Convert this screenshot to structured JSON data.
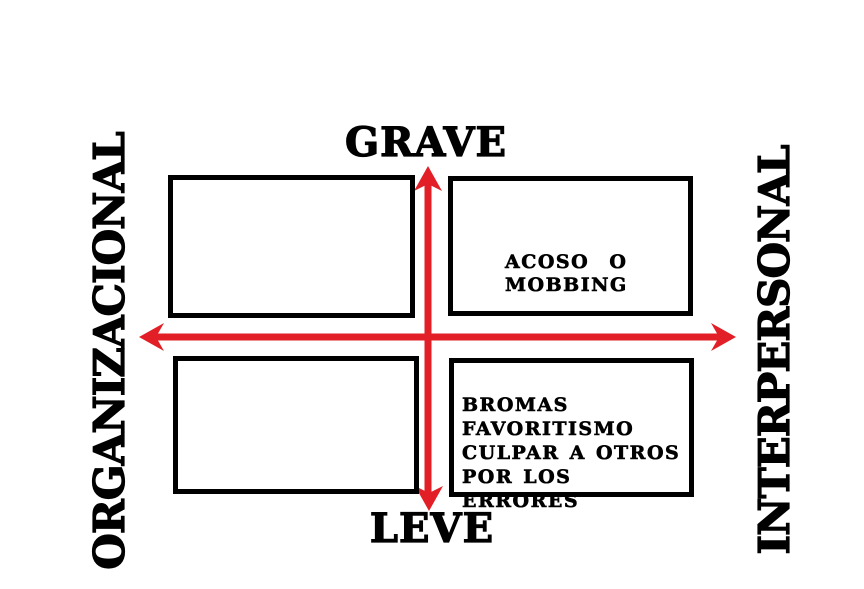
{
  "diagram": {
    "type": "quadrant-matrix",
    "subject": "workplace-conflict-severity-matrix",
    "colors": {
      "arrow_red": "#e21f26",
      "ink_black": "#000000",
      "background": "#ffffff"
    },
    "vertical_axis": {
      "top_label": "GRAVE",
      "bottom_label": "LEVE"
    },
    "horizontal_axis": {
      "left_label": "ORGANIZACIONAL",
      "right_label": "INTERPERSONAL"
    },
    "quadrants": {
      "top_left": {
        "text": ""
      },
      "top_right": {
        "text": "ACOSO  O\nMOBBING"
      },
      "bottom_left": {
        "text": ""
      },
      "bottom_right": {
        "text": "BROMAS\nFAVORITISMO\nCULPAR A OTROS\nPOR LOS ERRORES"
      }
    }
  }
}
